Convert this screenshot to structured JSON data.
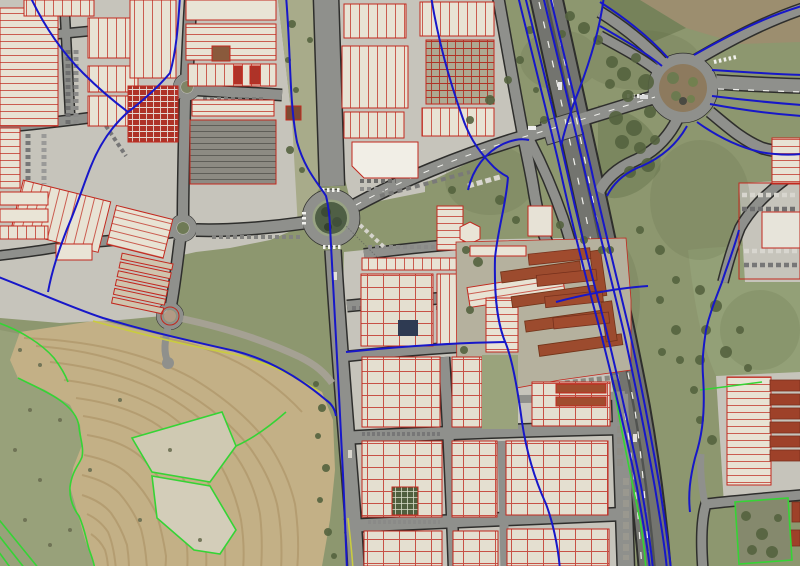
{
  "map": {
    "title": "Aerial orthophoto with cadastral overlay",
    "viewport": {
      "width_px": 800,
      "height_px": 566
    },
    "palette": {
      "grass": "#8d976f",
      "ground_industrial": "#c6c4bb",
      "field_tan": "#c3b086",
      "road_gray": "#8f908c",
      "highway_gray": "#73746f",
      "road_casing": "#2e2e2c",
      "cadastral_red": "#c2281e",
      "boundary_blue": "#1717c9",
      "boundary_green": "#35d435",
      "boundary_yellow": "#c9cc3f",
      "roundabout_green": "#4f5f45",
      "roof_light": "#e9e4d6",
      "roof_red": "#9e4a2e"
    },
    "layers": [
      {
        "id": "orthophoto",
        "label": "aerial imagery"
      },
      {
        "id": "roads",
        "label": "road network with black casings"
      },
      {
        "id": "cadastral-red",
        "label": "cadastral building / parcel outlines (red)"
      },
      {
        "id": "boundary-blue",
        "label": "cadastral boundary lines (blue)"
      },
      {
        "id": "boundary-green",
        "label": "rural parcel boundaries (green)"
      },
      {
        "id": "boundary-yellow",
        "label": "boundary lines (yellow)"
      }
    ],
    "features": {
      "roundabouts": [
        "main avenue roundabout (tree-filled island)",
        "motorway interchange roundabout (brown island)",
        "north industrial roundabout",
        "west industrial roundabout",
        "south-west industrial roundabout",
        "mini roundabout south"
      ],
      "motorway": "dual carriageway running top-centre to bottom-right with slip roads",
      "land_use": [
        "industrial estate with warehouse blocks",
        "motorway interchange",
        "ploughed field with contour ridges",
        "pasture and scrub"
      ],
      "street_name_label": "illegible small print along main avenue south-east of roundabout"
    }
  }
}
